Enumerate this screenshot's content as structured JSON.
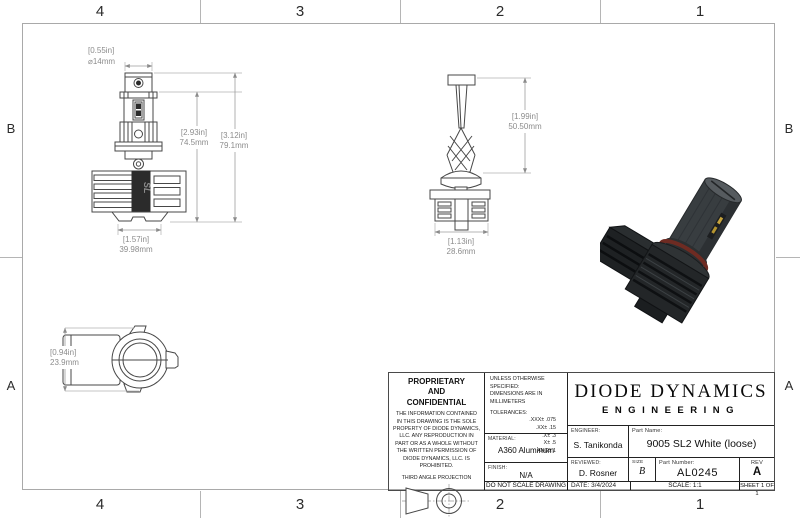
{
  "zones": {
    "top": [
      "4",
      "3",
      "2",
      "1"
    ],
    "bottom": [
      "4",
      "3",
      "2",
      "1"
    ],
    "left": [
      "B",
      "A"
    ],
    "right": [
      "B",
      "A"
    ]
  },
  "views": {
    "front": {
      "dia": {
        "in": "[0.55in]",
        "mm": "⌀14mm"
      },
      "body": {
        "in": "[2.93in]",
        "mm": "74.5mm"
      },
      "overall": {
        "in": "[3.12in]",
        "mm": "79.1mm"
      },
      "base": {
        "in": "[1.57in]",
        "mm": "39.98mm"
      },
      "logo": "SL"
    },
    "side": {
      "height": {
        "in": "[1.99in]",
        "mm": "50.50mm"
      },
      "width": {
        "in": "[1.13in]",
        "mm": "28.6mm"
      }
    },
    "top": {
      "height": {
        "in": "[0.94in]",
        "mm": "23.9mm"
      }
    }
  },
  "title_block": {
    "proprietary": {
      "title": "PROPRIETARY\nAND\nCONFIDENTIAL",
      "body": "THE INFORMATION CONTAINED IN THIS DRAWING IS THE SOLE PROPERTY OF DIODE DYNAMICS, LLC.  ANY REPRODUCTION IN PART OR AS A WHOLE WITHOUT THE WRITTEN PERMISSION OF DIODE DYNAMICS, LLC. IS PROHIBITED.",
      "projection_label": "THIRD ANGLE PROJECTION"
    },
    "specs": {
      "unless": "UNLESS OTHERWISE SPECIFIED:",
      "dims_note": "DIMENSIONS ARE IN MILLIMETERS",
      "tolerances_label": "TOLERANCES:",
      "tolerances": [
        ".XXX± .075",
        ".XX± .15",
        ".X± .3",
        "X± .5",
        "ANG± 1"
      ],
      "material_label": "MATERIAL:",
      "material": "A360 Aluminum",
      "finish_label": "FINISH:",
      "finish": "N/A",
      "no_scale": "DO NOT SCALE DRAWING"
    },
    "company": {
      "name": "DIODE DYNAMICS",
      "division": "ENGINEERING"
    },
    "fields": {
      "engineer_label": "ENGINEER:",
      "engineer": "S. Tanikonda",
      "part_name_label": "Part Name:",
      "part_name": "9005 SL2 White (loose)",
      "reviewed_label": "REVIEWED:",
      "reviewed": "D. Rosner",
      "size_label": "SIZE",
      "size": "B",
      "part_number_label": "Part Number:",
      "part_number": "AL0245",
      "rev_label": "REV",
      "rev": "A",
      "date_label": "DATE:",
      "date": "3/4/2024",
      "scale_label": "SCALE:",
      "scale": "1:1",
      "sheet": "SHEET 1 OF 1"
    }
  },
  "colors": {
    "drawing_line": "#474747",
    "dimension_text": "#8c8c8c",
    "render_body": "#383d40",
    "render_oring": "#6e2b22",
    "render_led": "#c7a43c"
  }
}
